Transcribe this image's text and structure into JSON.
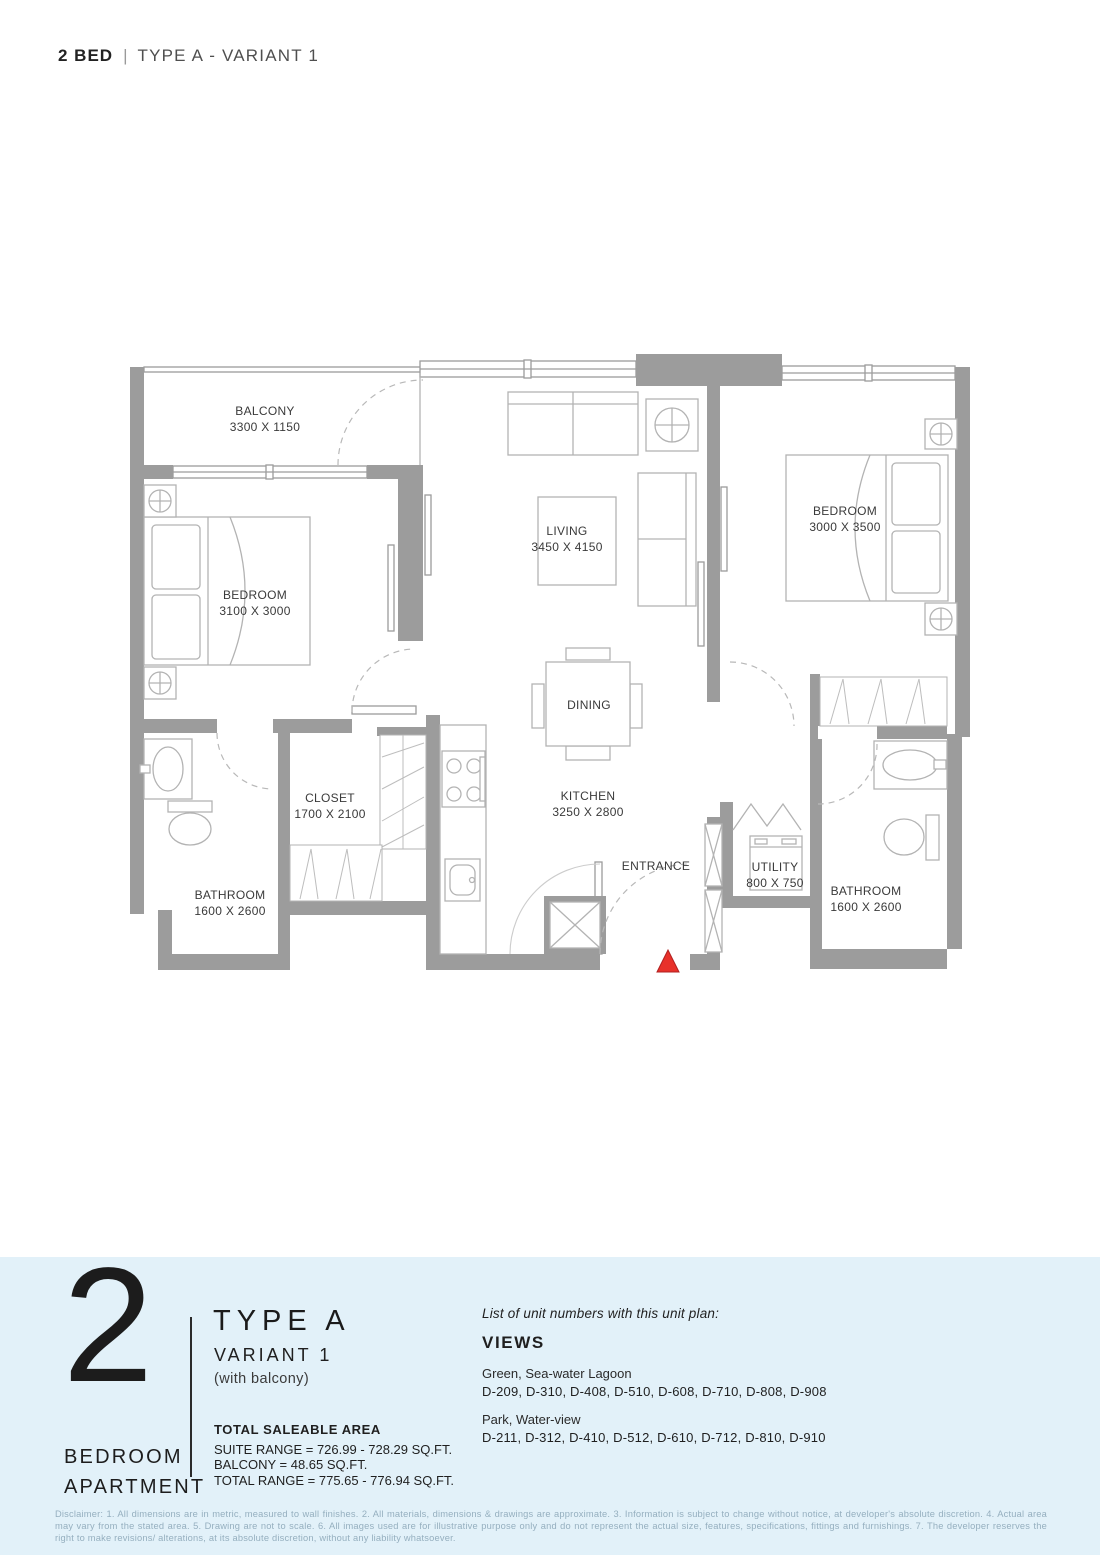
{
  "header": {
    "bed": "2 BED",
    "sep": "|",
    "variant": "TYPE A - VARIANT 1"
  },
  "plan": {
    "balcony": {
      "name": "BALCONY",
      "dims": "3300 X 1150"
    },
    "bedroom_left": {
      "name": "BEDROOM",
      "dims": "3100 X 3000"
    },
    "living": {
      "name": "LIVING",
      "dims": "3450 X 4150"
    },
    "bedroom_right": {
      "name": "BEDROOM",
      "dims": "3000 X 3500"
    },
    "dining": {
      "name": "DINING"
    },
    "closet": {
      "name": "CLOSET",
      "dims": "1700 X 2100"
    },
    "kitchen": {
      "name": "KITCHEN",
      "dims": "3250 X 2800"
    },
    "entrance": {
      "name": "ENTRANCE"
    },
    "utility": {
      "name": "UTILITY",
      "dims": "800 X 750"
    },
    "bathroom_left": {
      "name": "BATHROOM",
      "dims": "1600 X 2600"
    },
    "bathroom_right": {
      "name": "BATHROOM",
      "dims": "1600 X 2600"
    },
    "colors": {
      "wall": "#9c9c9c",
      "furniture": "#b3b3b3",
      "label": "#3a3a3a",
      "entrance_marker": "#e8312a"
    }
  },
  "footer": {
    "panel_color": "#e2f1f9",
    "unit_count": "2",
    "unit_line1": "BEDROOM",
    "unit_line2": "APARTMENT",
    "type_title": "TYPE A",
    "type_variant": "VARIANT 1",
    "type_note": "(with balcony)",
    "area": {
      "heading": "TOTAL SALEABLE AREA",
      "suite": "SUITE RANGE = 726.99 - 728.29 SQ.FT.",
      "balcony": "BALCONY = 48.65 SQ.FT.",
      "total": "TOTAL RANGE = 775.65 - 776.94 SQ.FT."
    },
    "units": {
      "intro": "List of unit numbers with this unit plan:",
      "heading": "VIEWS",
      "groups": [
        {
          "view": "Green, Sea-water Lagoon",
          "numbers": "D-209, D-310, D-408, D-510, D-608, D-710, D-808, D-908"
        },
        {
          "view": "Park, Water-view",
          "numbers": "D-211, D-312, D-410, D-512, D-610, D-712, D-810, D-910"
        }
      ]
    }
  },
  "disclaimer": {
    "text": "Disclaimer: 1. All dimensions are in metric, measured to wall finishes. 2. All materials, dimensions & drawings are approximate. 3. Information is subject to change without notice, at developer's absolute discretion. 4. Actual area may vary from the stated area. 5. Drawing are not to scale. 6. All images used are for illustrative purpose only and do not represent the actual size, features, specifications, fittings and furnishings. 7. The developer reserves the right to make revisions/ alterations, at its absolute discretion, without any liability whatsoever."
  }
}
